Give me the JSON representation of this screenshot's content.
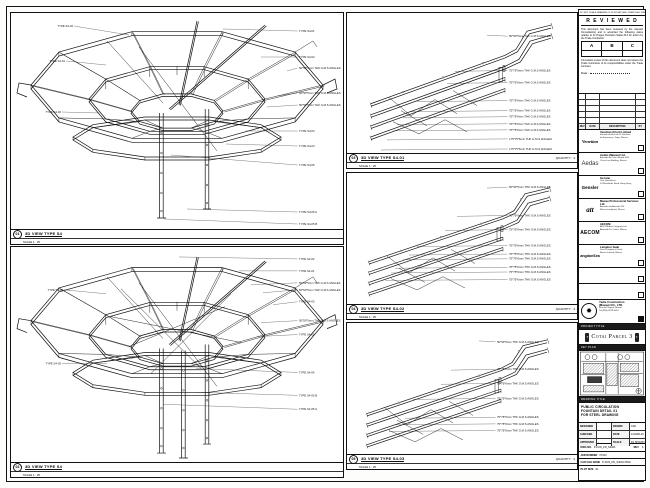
{
  "sheet": {
    "disclaimer": "DO NOT SCALE DRAWING. IF IN DOUBT, ASK. VERIFY ALL DIMENSIONS ON SITE."
  },
  "review_stamp": {
    "title": "R E V I E W E D",
    "para1": "This document has been reviewed by the relevant Consultant(s) and is accorded the following status relative to its Project Provision Status B.4 for action by the Trade Contractor.",
    "grades": [
      "A",
      "B",
      "C"
    ],
    "para2": "Consultant review of this document does not relieve the Trade Contractor of its responsibilities under the Trade Contract.",
    "date_label": "Date :"
  },
  "revision_table": {
    "headers": [
      "REV",
      "DATE",
      "DESCRIPTION",
      "BY"
    ],
    "empty_rows": 5
  },
  "consultants": [
    {
      "logo": "Venetian",
      "logo_class": "la-venetian",
      "name": "Venetian Orient Limited",
      "lines": [
        "Estrada da Baia de N. Senhora",
        "da Esperanca, Taipa, Macau"
      ],
      "checked": false
    },
    {
      "logo": "Aedas",
      "logo_class": "la-aedas",
      "name": "Aedas (Macau) Ltd.",
      "lines": [
        "Avenida da Praia Grande 409",
        "China Law Building, Macau"
      ],
      "checked": false
    },
    {
      "logo": "Gensler",
      "logo_class": "la-gensler",
      "name": "Gensler",
      "lines": [
        "One Island East",
        "18 Westlands Road, Hong Kong"
      ],
      "checked": false
    },
    {
      "logo": "att",
      "logo_class": "la-att",
      "name": "Macau Professional Services Ltd.",
      "lines": [
        "Avenida da Amizade 555",
        "Macau Landmark, Macau"
      ],
      "checked": false
    },
    {
      "logo": "AECOM",
      "logo_class": "la-aecom",
      "name": "AECOM",
      "lines": [
        "AECOM Asia Company Ltd.",
        "Alameda Dr. Carlos, Macau"
      ],
      "checked": false
    },
    {
      "logo": "LangdonSeah",
      "logo_class": "la-langdon",
      "name": "Langdon Seah",
      "lines": [
        "Davis Langdon & Seah",
        "Macau Limited, Macau"
      ],
      "checked": false
    }
  ],
  "empty_slots": 2,
  "contractor": {
    "logo_glyph": "✸",
    "name": "Yadie Construction",
    "name2": "(Macau) CO., LTD.",
    "lines": [
      "Rua de Pequim, Macau",
      "Tel (853) 2878 0000"
    ],
    "checked": true
  },
  "project_strip": "PROJECT TITLE",
  "project_banner": "Cotai Parcel 3",
  "keyplan_strip": "KEY PLAN",
  "title_block": {
    "strip": "DRAWING TITLE",
    "title_lines": [
      "PUBLIC CIRCULATION",
      "FOUNTAIN DETAIL 01",
      "FOR STEEL DRAWING"
    ],
    "fields": {
      "designed_label": "DESIGNED",
      "designed": "-",
      "drawn_label": "DRAWN",
      "drawn": "CAD",
      "checked_label": "CHECKED",
      "checked": "-",
      "date_label": "DATE",
      "date": "14-MAR-16",
      "approved_label": "APPROVED",
      "approved": "-",
      "scale_label": "SCALE",
      "scale": "AS SHOWN"
    },
    "dwg_label": "DWG NO.",
    "dwg_no": "P-FUN_FD_S4001",
    "rev_label": "REV",
    "rev": "A",
    "job_label": "JOB NUMBER",
    "job": "07103",
    "cad_label": "CAD FILE NAME",
    "cad": "P-FUN_FD_S4001.DWG",
    "note_label": "PLOT SIZE",
    "note": "A1"
  },
  "views": [
    {
      "num": "01",
      "title": "3D VIEW TYPE S4",
      "scale": "SCALE 1 : 25",
      "quantity": "",
      "annotations": [
        {
          "t": "TYPE S4-02",
          "x": 62,
          "y": 14,
          "px": 118,
          "py": 22,
          "side": "left"
        },
        {
          "t": "TYPE S4-01",
          "x": 54,
          "y": 49,
          "px": 95,
          "py": 52,
          "side": "left"
        },
        {
          "t": "TYPE S4-02",
          "x": 50,
          "y": 100,
          "px": 88,
          "py": 100,
          "side": "left"
        },
        {
          "t": "TYPE S4-01",
          "x": 288,
          "y": 19,
          "px": 212,
          "py": 16,
          "side": "right"
        },
        {
          "t": "TYPE S4-02",
          "x": 288,
          "y": 45,
          "px": 250,
          "py": 44,
          "side": "right"
        },
        {
          "t": "50*50*5mm THK G.M.S ANGLES",
          "x": 288,
          "y": 56,
          "px": 276,
          "py": 58,
          "side": "right"
        },
        {
          "t": "50*50*5mm THK G.M.S ANGLES",
          "x": 288,
          "y": 81,
          "px": 266,
          "py": 83,
          "side": "right"
        },
        {
          "t": "50*50*5mm THK G.M.S ANGLES",
          "x": 288,
          "y": 93,
          "px": 256,
          "py": 94,
          "side": "right"
        },
        {
          "t": "TYPE S4-03",
          "x": 288,
          "y": 119,
          "px": 235,
          "py": 118,
          "side": "right"
        },
        {
          "t": "TYPE S4-04",
          "x": 288,
          "y": 134,
          "px": 215,
          "py": 131,
          "side": "right"
        },
        {
          "t": "TYPE S4-05",
          "x": 288,
          "y": 153,
          "px": 160,
          "py": 142,
          "side": "right"
        },
        {
          "t": "TYPE S4-05 A",
          "x": 288,
          "y": 200,
          "px": 176,
          "py": 196,
          "side": "right"
        },
        {
          "t": "TYPE S4-05 B",
          "x": 288,
          "y": 212,
          "px": 153,
          "py": 206,
          "side": "right"
        }
      ]
    },
    {
      "num": "02",
      "title": "3D VIEW TYPE S4",
      "scale": "SCALE 1 : 25",
      "quantity": "",
      "annotations": [
        {
          "t": "TYPE S4-02",
          "x": 52,
          "y": 44,
          "px": 95,
          "py": 47,
          "side": "left"
        },
        {
          "t": "TYPE S4-03",
          "x": 50,
          "y": 118,
          "px": 96,
          "py": 117,
          "side": "left"
        },
        {
          "t": "TYPE S4-02",
          "x": 288,
          "y": 13,
          "px": 168,
          "py": 10,
          "side": "right"
        },
        {
          "t": "TYPE S4-01",
          "x": 288,
          "y": 25,
          "px": 228,
          "py": 24,
          "side": "right"
        },
        {
          "t": "50*50*5mm THK G.M.S ANGLES",
          "x": 288,
          "y": 37,
          "px": 240,
          "py": 38,
          "side": "right"
        },
        {
          "t": "50*50*5mm THK G.M.S ANGLES",
          "x": 288,
          "y": 44,
          "px": 252,
          "py": 46,
          "side": "right"
        },
        {
          "t": "TYPE S4-03",
          "x": 288,
          "y": 56,
          "px": 262,
          "py": 58,
          "side": "right"
        },
        {
          "t": "50*50*5mm THK G.M.S ANGLES",
          "x": 288,
          "y": 75,
          "px": 250,
          "py": 76,
          "side": "right"
        },
        {
          "t": "TYPE S4-02",
          "x": 288,
          "y": 89,
          "px": 246,
          "py": 90,
          "side": "right"
        },
        {
          "t": "TYPE S4-04",
          "x": 288,
          "y": 127,
          "px": 185,
          "py": 122,
          "side": "right"
        },
        {
          "t": "TYPE S4-05 B",
          "x": 288,
          "y": 150,
          "px": 186,
          "py": 146,
          "side": "right"
        },
        {
          "t": "TYPE S4-05 A",
          "x": 288,
          "y": 164,
          "px": 152,
          "py": 158,
          "side": "right"
        }
      ]
    },
    {
      "num": "03",
      "title": "3D VIEW TYPE S4-01",
      "scale": "SCALE 1 : 25",
      "quantity": "QUANTITY : 4",
      "annotations": [
        {
          "t": "50*50*5mm THK G.M.S ANGLES",
          "x": 162,
          "y": 24,
          "px": 140,
          "py": 22,
          "side": "right"
        },
        {
          "t": "75*75*6mm THK G.M.S ANGLES",
          "x": 162,
          "y": 58,
          "px": 108,
          "py": 58,
          "side": "right"
        },
        {
          "t": "75*75*6mm THK G.M.S ANGLES",
          "x": 162,
          "y": 70,
          "px": 100,
          "py": 70,
          "side": "right"
        },
        {
          "t": "75*75*6mm THK G.M.S ANGLES",
          "x": 162,
          "y": 88,
          "px": 70,
          "py": 88,
          "side": "right"
        },
        {
          "t": "75*75*6mm THK G.M.S ANGLES",
          "x": 162,
          "y": 98,
          "px": 62,
          "py": 98,
          "side": "right"
        },
        {
          "t": "75*75*6mm THK G.M.S ANGLES",
          "x": 162,
          "y": 104,
          "px": 56,
          "py": 104,
          "side": "right"
        },
        {
          "t": "75*75*6mm THK G.M.S ANGLES",
          "x": 162,
          "y": 111,
          "px": 50,
          "py": 111,
          "side": "right"
        },
        {
          "t": "75*75*6mm THK G.M.S ANGLES",
          "x": 162,
          "y": 117,
          "px": 46,
          "py": 117,
          "side": "right"
        },
        {
          "t": "L75*75*6mm THK G.M.S ANGLES",
          "x": 162,
          "y": 126,
          "px": 40,
          "py": 126,
          "side": "right"
        },
        {
          "t": "L75*75*6mm THK G.M.S ANGLES",
          "x": 162,
          "y": 136,
          "px": 34,
          "py": 136,
          "side": "right"
        }
      ]
    },
    {
      "num": "04",
      "title": "3D VIEW TYPE S4-02",
      "scale": "SCALE 1 : 25",
      "quantity": "QUANTITY : 4",
      "annotations": [
        {
          "t": "50*50*5mm THK G.M.S ANGLES",
          "x": 162,
          "y": 16,
          "px": 140,
          "py": 16,
          "side": "right"
        },
        {
          "t": "75*75*6mm THK G.M.S ANGLES",
          "x": 162,
          "y": 46,
          "px": 110,
          "py": 46,
          "side": "right"
        },
        {
          "t": "75*75*6mm THK G.M.S ANGLES",
          "x": 162,
          "y": 61,
          "px": 98,
          "py": 61,
          "side": "right"
        },
        {
          "t": "75*75*6mm THK G.M.S ANGLES",
          "x": 162,
          "y": 78,
          "px": 70,
          "py": 78,
          "side": "right"
        },
        {
          "t": "75*75*6mm THK G.M.S ANGLES",
          "x": 162,
          "y": 87,
          "px": 62,
          "py": 87,
          "side": "right"
        },
        {
          "t": "75*75*6mm THK G.M.S ANGLES",
          "x": 162,
          "y": 92,
          "px": 56,
          "py": 92,
          "side": "right"
        },
        {
          "t": "75*75*6mm THK G.M.S ANGLES",
          "x": 162,
          "y": 101,
          "px": 48,
          "py": 101,
          "side": "right"
        },
        {
          "t": "75*75*6mm THK G.M.S ANGLES",
          "x": 162,
          "y": 106,
          "px": 44,
          "py": 106,
          "side": "right"
        },
        {
          "t": "75*75*6mm THK G.M.S ANGLES",
          "x": 162,
          "y": 114,
          "px": 38,
          "py": 114,
          "side": "right"
        }
      ]
    },
    {
      "num": "05",
      "title": "3D VIEW TYPE S4-03",
      "scale": "SCALE 1 : 25",
      "quantity": "QUANTITY : 4",
      "annotations": [
        {
          "t": "50*50*5mm THK G.M.S ANGLES",
          "x": 150,
          "y": 21,
          "px": 132,
          "py": 19,
          "side": "right"
        },
        {
          "t": "75*75*6mm THK G.M.S ANGLES",
          "x": 150,
          "y": 50,
          "px": 104,
          "py": 50,
          "side": "right"
        },
        {
          "t": "75*75*6mm THK G.M.S ANGLES",
          "x": 150,
          "y": 65,
          "px": 94,
          "py": 65,
          "side": "right"
        },
        {
          "t": "75*75*6mm THK G.M.S ANGLES",
          "x": 150,
          "y": 81,
          "px": 66,
          "py": 81,
          "side": "right"
        },
        {
          "t": "75*75*6mm THK G.M.S ANGLES",
          "x": 150,
          "y": 101,
          "px": 58,
          "py": 101,
          "side": "right"
        },
        {
          "t": "75*75*6mm THK G.M.S ANGLES",
          "x": 150,
          "y": 108,
          "px": 48,
          "py": 108,
          "side": "right"
        },
        {
          "t": "75*75*6mm THK G.M.S ANGLES",
          "x": 150,
          "y": 115,
          "px": 42,
          "py": 115,
          "side": "right"
        }
      ]
    }
  ]
}
